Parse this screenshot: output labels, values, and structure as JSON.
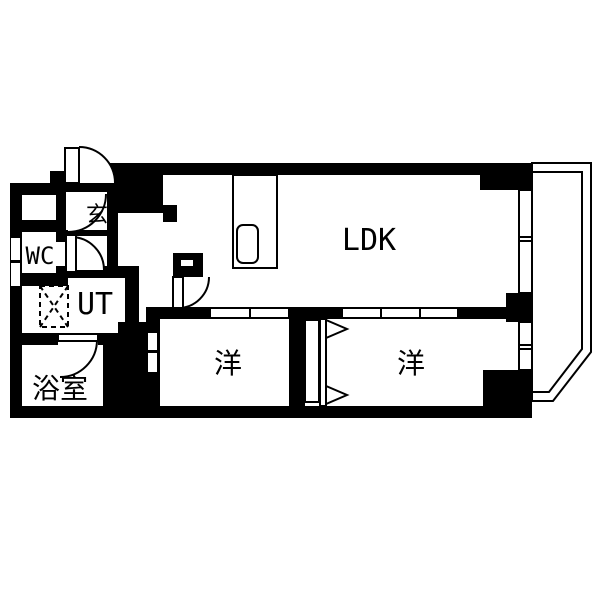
{
  "meta": {
    "drawing_type": "apartment-floor-plan"
  },
  "palette": {
    "wall": "#000000",
    "bg": "#ffffff",
    "line": "#000000"
  },
  "rooms": [
    {
      "name": "room-label-genkan",
      "label": "玄",
      "x": 97,
      "y": 222,
      "size": 22
    },
    {
      "name": "room-label-wc",
      "label": "WC",
      "x": 40,
      "y": 264,
      "size": 24
    },
    {
      "name": "room-label-ut",
      "label": "UT",
      "x": 95,
      "y": 314,
      "size": 30
    },
    {
      "name": "room-label-bathroom",
      "label": "浴室",
      "x": 60,
      "y": 398,
      "size": 28
    },
    {
      "name": "room-label-ldk",
      "label": "LDK",
      "x": 369,
      "y": 250,
      "size": 30
    },
    {
      "name": "room-label-bedroom-left",
      "label": "洋",
      "x": 228,
      "y": 373,
      "size": 28
    },
    {
      "name": "room-label-bedroom-right",
      "label": "洋",
      "x": 411,
      "y": 373,
      "size": 28
    }
  ],
  "walls": [
    {
      "x": 107,
      "y": 163,
      "w": 425,
      "h": 12,
      "n": "top-wall"
    },
    {
      "x": 10,
      "y": 183,
      "w": 12,
      "h": 235,
      "n": "left-wall"
    },
    {
      "x": 10,
      "y": 406,
      "w": 522,
      "h": 12,
      "n": "bottom-wall"
    },
    {
      "x": 10,
      "y": 183,
      "w": 56,
      "h": 12,
      "n": "wc-top-outer-wall"
    },
    {
      "x": 50,
      "y": 171,
      "w": 16,
      "h": 12,
      "n": "entry-jamb"
    },
    {
      "x": 66,
      "y": 183,
      "w": 41,
      "h": 9,
      "n": "genkan-north-wall"
    },
    {
      "x": 66,
      "y": 230,
      "w": 41,
      "h": 6,
      "n": "genkan-south-wall"
    },
    {
      "x": 22,
      "y": 220,
      "w": 44,
      "h": 12,
      "n": "wc-north-wall"
    },
    {
      "x": 56,
      "y": 195,
      "w": 10,
      "h": 37,
      "n": "wc-east-wall-upper"
    },
    {
      "x": 56,
      "y": 232,
      "w": 10,
      "h": 10,
      "n": "wc-east-jamb-top"
    },
    {
      "x": 56,
      "y": 266,
      "w": 10,
      "h": 12,
      "n": "wc-east-jamb-bottom"
    },
    {
      "x": 10,
      "y": 273,
      "w": 58,
      "h": 13,
      "n": "wc-south-wall"
    },
    {
      "x": 66,
      "y": 266,
      "w": 62,
      "h": 12,
      "n": "ut-north-wall"
    },
    {
      "x": 125,
      "y": 266,
      "w": 14,
      "h": 66,
      "n": "ut-east-wall"
    },
    {
      "x": 22,
      "y": 333,
      "w": 36,
      "h": 12,
      "n": "bath-north-wall-left"
    },
    {
      "x": 98,
      "y": 333,
      "w": 20,
      "h": 12,
      "n": "bath-north-wall-right"
    },
    {
      "x": 103,
      "y": 345,
      "w": 16,
      "h": 61,
      "n": "bath-east-wall"
    },
    {
      "x": 118,
      "y": 322,
      "w": 28,
      "h": 84,
      "n": "hall-bedroom-wall-block"
    },
    {
      "x": 146,
      "y": 307,
      "w": 64,
      "h": 12,
      "n": "bedroom-left-north-wall"
    },
    {
      "x": 146,
      "y": 308,
      "w": 14,
      "h": 98,
      "n": "bedroom-left-west-wall"
    },
    {
      "x": 289,
      "y": 307,
      "w": 53,
      "h": 12,
      "n": "bedrooms-north-wall-mid"
    },
    {
      "x": 458,
      "y": 307,
      "w": 74,
      "h": 12,
      "n": "bedroom-right-north-wall"
    },
    {
      "x": 112,
      "y": 165,
      "w": 51,
      "h": 48,
      "n": "kitchen-west-block"
    },
    {
      "x": 163,
      "y": 205,
      "w": 14,
      "h": 17,
      "n": "kitchen-west-pillar"
    },
    {
      "x": 107,
      "y": 165,
      "w": 11,
      "h": 101,
      "n": "genkan-east-wall"
    },
    {
      "x": 173,
      "y": 253,
      "w": 30,
      "h": 24,
      "n": "ldk-door-pillar"
    },
    {
      "x": 480,
      "y": 163,
      "w": 52,
      "h": 27,
      "n": "ldk-ne-corner-block"
    },
    {
      "x": 506,
      "y": 293,
      "w": 26,
      "h": 29,
      "n": "east-wall-mid-block"
    },
    {
      "x": 483,
      "y": 370,
      "w": 49,
      "h": 48,
      "n": "se-corner-block"
    },
    {
      "x": 289,
      "y": 319,
      "w": 16,
      "h": 87,
      "n": "bedrooms-divider-wall"
    },
    {
      "x": 263,
      "y": 172,
      "w": 14,
      "h": 51,
      "n": "kitchen-partition-stub"
    }
  ],
  "gaps": [
    {
      "x": 11,
      "y": 238,
      "w": 9,
      "h": 22,
      "n": "wc-wall-vent-slit-1"
    },
    {
      "x": 11,
      "y": 263,
      "w": 9,
      "h": 23,
      "n": "wc-wall-vent-slit-2"
    },
    {
      "x": 181,
      "y": 260,
      "w": 12,
      "h": 6,
      "n": "ldk-pillar-notch"
    },
    {
      "x": 148,
      "y": 333,
      "w": 9,
      "h": 17,
      "n": "bedroom-left-wall-slit-1"
    },
    {
      "x": 148,
      "y": 353,
      "w": 9,
      "h": 19,
      "n": "bedroom-left-wall-slit-2"
    }
  ],
  "fixtures": [
    {
      "x": 65,
      "y": 148,
      "w": 14,
      "h": 35,
      "n": "entry-door-leaf"
    },
    {
      "x": 66,
      "y": 235,
      "w": 10,
      "h": 37,
      "n": "wc-door-leaf"
    },
    {
      "x": 58,
      "y": 334,
      "w": 40,
      "h": 7,
      "n": "bath-door-leaf"
    },
    {
      "x": 173,
      "y": 277,
      "w": 10,
      "h": 31,
      "n": "ldk-door-leaf"
    },
    {
      "x": 210,
      "y": 308,
      "w": 40,
      "h": 10,
      "n": "bedroom-left-sliding-panel-1"
    },
    {
      "x": 250,
      "y": 308,
      "w": 39,
      "h": 10,
      "n": "bedroom-left-sliding-panel-2"
    },
    {
      "x": 342,
      "y": 308,
      "w": 39,
      "h": 10,
      "n": "bedroom-right-sliding-panel-1"
    },
    {
      "x": 381,
      "y": 308,
      "w": 39,
      "h": 10,
      "n": "bedroom-right-sliding-panel-2"
    },
    {
      "x": 420,
      "y": 308,
      "w": 38,
      "h": 10,
      "n": "bedroom-right-sliding-panel-3"
    },
    {
      "x": 519,
      "y": 190,
      "w": 13,
      "h": 103,
      "n": "ldk-window"
    },
    {
      "x": 519,
      "y": 322,
      "w": 13,
      "h": 48,
      "n": "bedroom-right-window"
    },
    {
      "x": 233,
      "y": 175,
      "w": 44,
      "h": 93,
      "n": "kitchen-counter"
    },
    {
      "x": 305,
      "y": 320,
      "w": 14,
      "h": 82,
      "n": "closet-back-panel"
    },
    {
      "x": 320,
      "y": 319,
      "w": 6,
      "h": 87,
      "n": "closet-door-track"
    }
  ],
  "dividers": [
    {
      "x1": 519,
      "y1": 237,
      "x2": 532,
      "y2": 237,
      "n": "ldk-window-divider-1"
    },
    {
      "x1": 519,
      "y1": 241,
      "x2": 532,
      "y2": 241,
      "n": "ldk-window-divider-2"
    },
    {
      "x1": 519,
      "y1": 345,
      "x2": 532,
      "y2": 345,
      "n": "bedroom-window-divider-1"
    },
    {
      "x1": 519,
      "y1": 349,
      "x2": 532,
      "y2": 349,
      "n": "bedroom-window-divider-2"
    }
  ],
  "arcs": [
    {
      "cx": 79,
      "cy": 183,
      "sx": 79,
      "sy": 147,
      "ex": 115,
      "ey": 183,
      "r": 36,
      "sweep": 1,
      "n": "entry-door-swing"
    },
    {
      "cx": 68,
      "cy": 194,
      "sx": 106,
      "sy": 194,
      "ex": 68,
      "ey": 232,
      "r": 38,
      "sweep": 1,
      "n": "genkan-door-swing"
    },
    {
      "cx": 71,
      "cy": 270,
      "sx": 71,
      "sy": 237,
      "ex": 104,
      "ey": 270,
      "r": 33,
      "sweep": 1,
      "n": "wc-door-swing"
    },
    {
      "cx": 60,
      "cy": 340,
      "sx": 97,
      "sy": 340,
      "ex": 60,
      "ey": 377,
      "r": 37,
      "sweep": 1,
      "n": "bath-door-swing"
    },
    {
      "cx": 178,
      "cy": 277,
      "sx": 178,
      "sy": 308,
      "ex": 209,
      "ey": 277,
      "r": 31,
      "sweep": 0,
      "n": "ldk-door-swing"
    }
  ],
  "triangles": [
    {
      "pts": "326,320 326,338 347,329",
      "n": "closet-folding-door-arrow-top"
    },
    {
      "pts": "326,386 326,404 347,395",
      "n": "closet-folding-door-arrow-bottom"
    }
  ],
  "balcony": {
    "outer": "532,163 591,163 591,352 553,401 532,401",
    "inner": "532,172 582,172 582,349 549,392 532,392",
    "n": "balcony-outline"
  },
  "washer": {
    "x": 40,
    "y": 286,
    "w": 28,
    "h": 41,
    "n": "washing-machine-space"
  },
  "sink": {
    "x": 237,
    "y": 225,
    "w": 21,
    "h": 38,
    "rx": 6,
    "n": "kitchen-sink"
  }
}
